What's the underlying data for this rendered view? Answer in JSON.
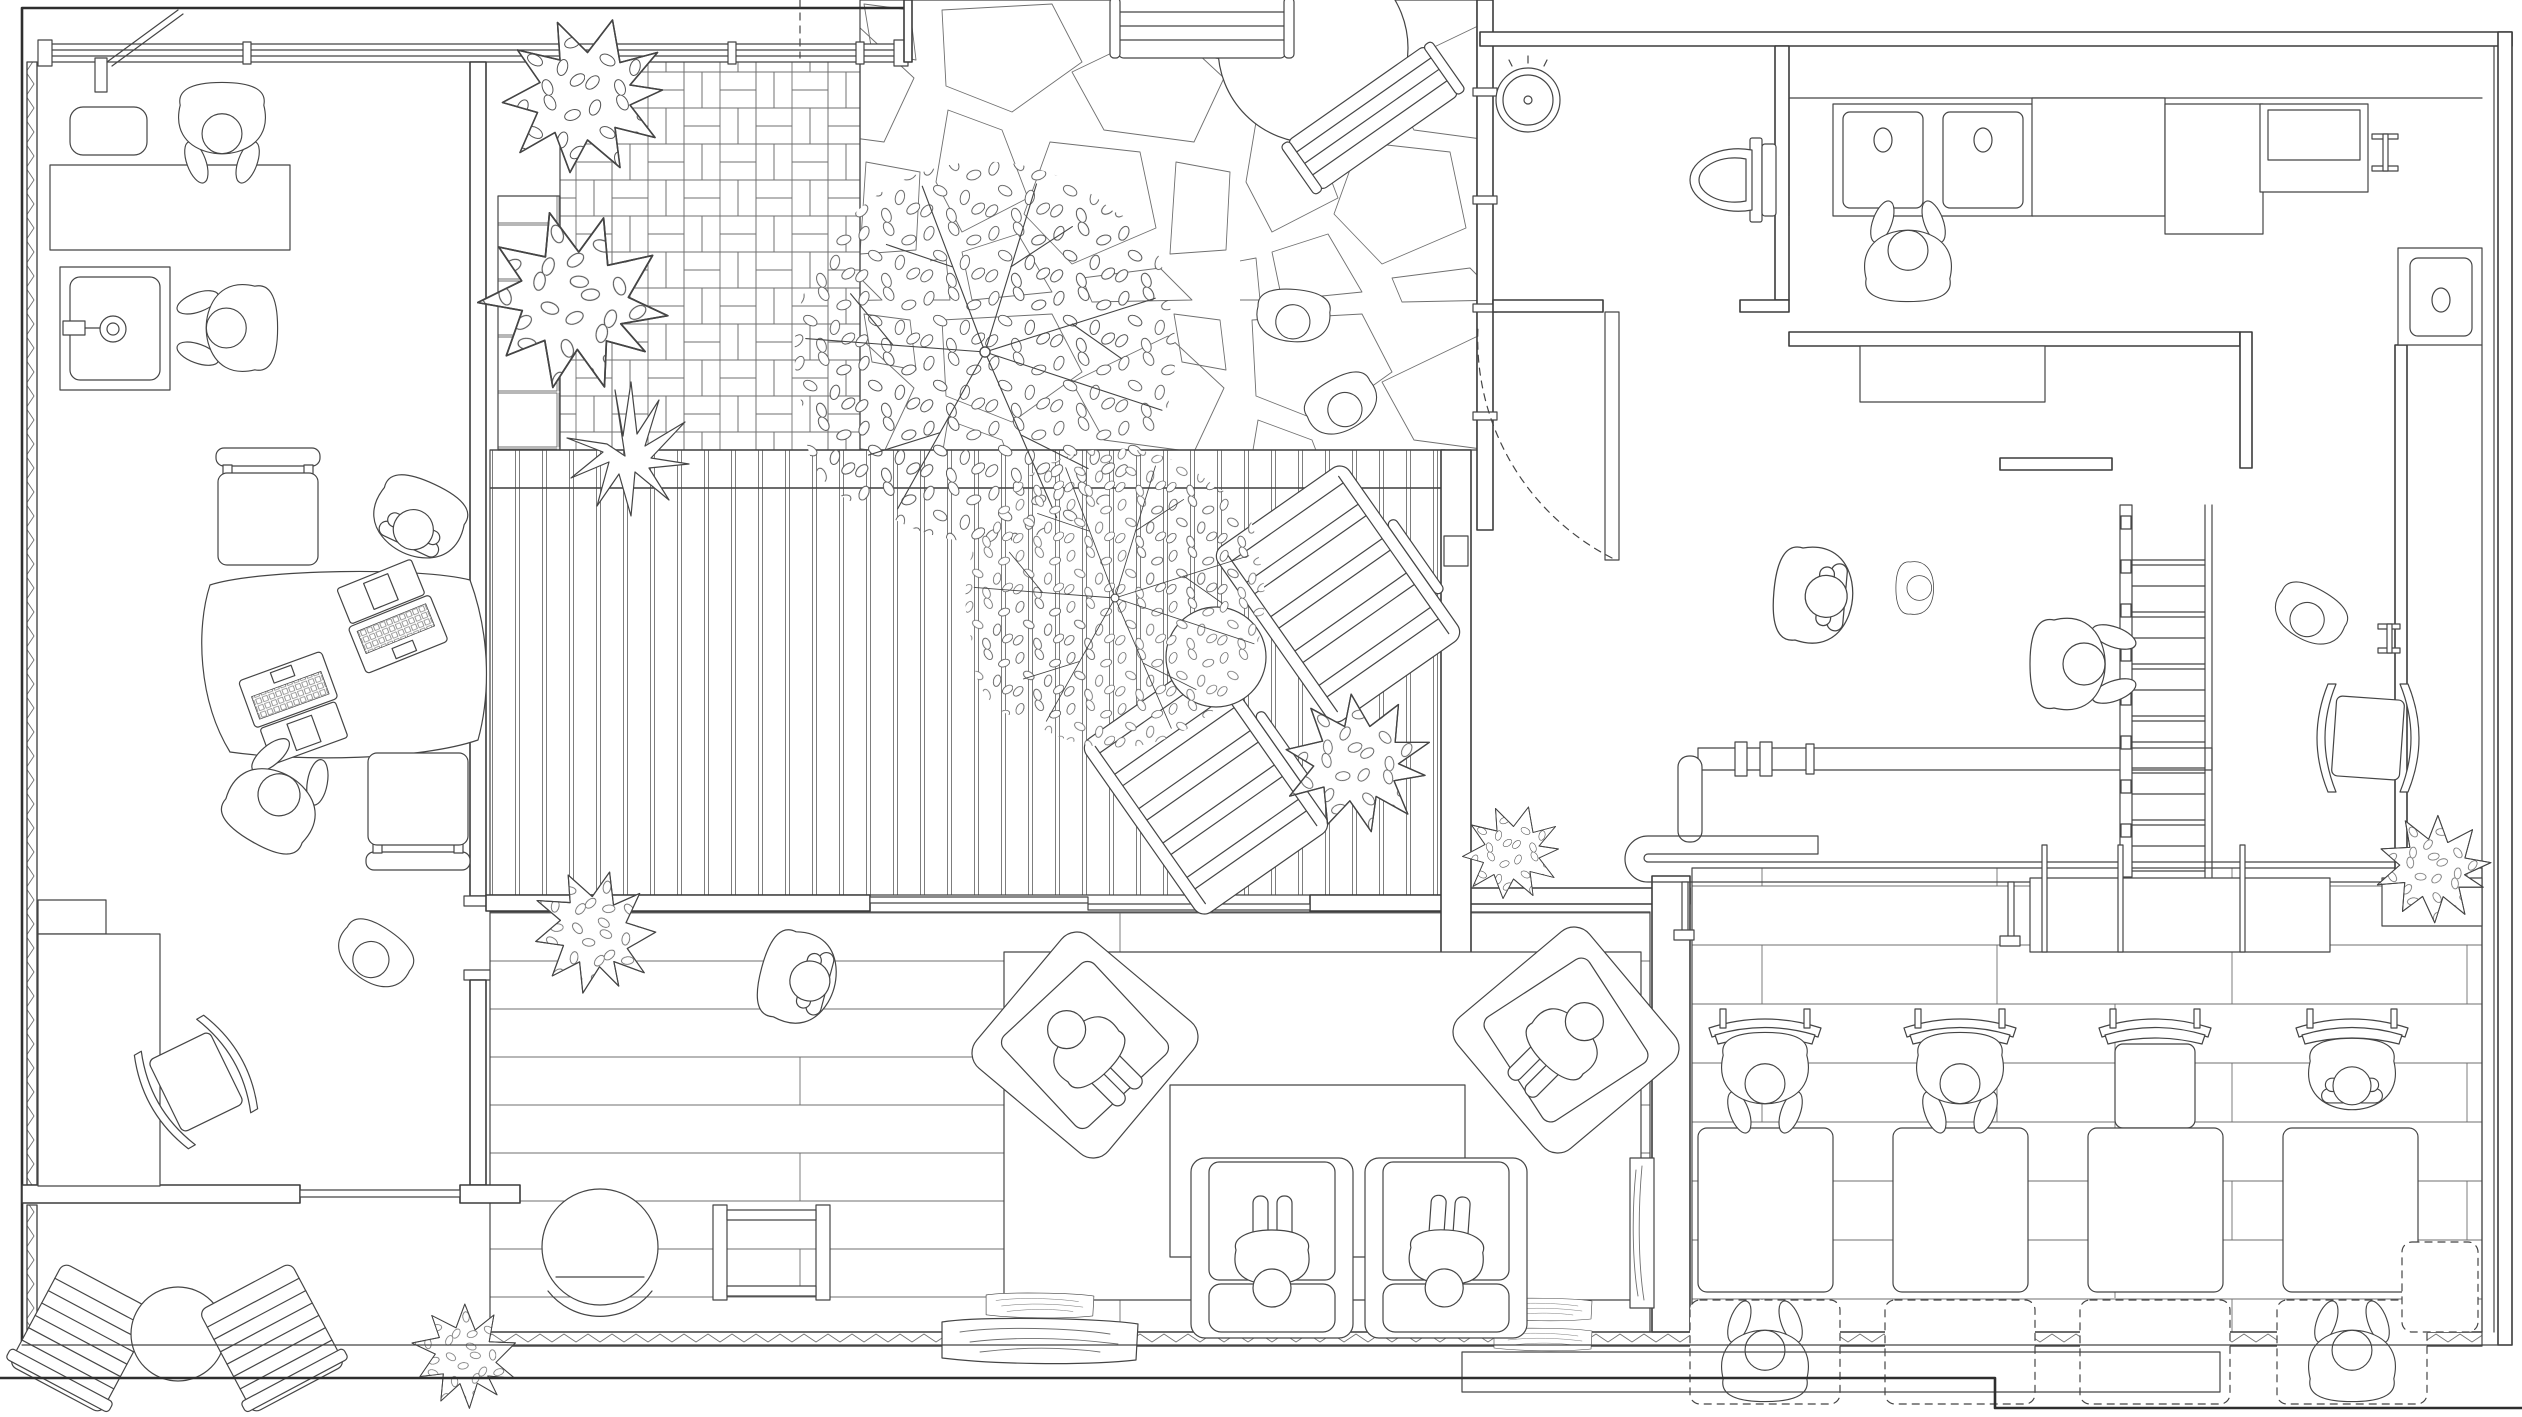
{
  "document": {
    "title": "Architectural floor plan (top view, black-and-white line drawing) of a co-living house: office studio, courtyard garden, timber deck, WC, kitchen, stair hall, lounge and dining study hall",
    "type": "floor-plan",
    "drawing_style": "monochrome CAD linework, no text labels, no dimensions"
  },
  "palette": {
    "background": "#ffffff",
    "linework": "#454545",
    "walls": "#3c3c3c",
    "pattern_linework": "#6f6f6f"
  },
  "floor_finishes": [
    "basketweave brick paving (courtyard)",
    "large stacked pavers (courtyard edge strip)",
    "crazy paving stone (courtyard path)",
    "vertical timber decking (terrace)",
    "wide timber planks (lounge)",
    "running-bond brick paviors (dining hall)"
  ],
  "rooms": [
    {
      "id": "office",
      "name": "office studio",
      "people": 5,
      "items": [
        "worktop appliance",
        "service counter",
        "inset sink with mixer tap",
        "organic work table",
        "laptop x2",
        "task chair x2",
        "storage cabinet",
        "rocking chair",
        "sliding door"
      ]
    },
    {
      "id": "courtyard",
      "name": "courtyard garden",
      "people": 2,
      "items": [
        "round table",
        "slatted bench x2",
        "large leafy tree",
        "shrub bed",
        "agave plant",
        "glazed screen wall"
      ]
    },
    {
      "id": "deck",
      "name": "deck terrace",
      "people": 0,
      "items": [
        "sun lounger x2",
        "ball side table",
        "small leafy tree",
        "shrub"
      ]
    },
    {
      "id": "wc",
      "name": "wc / powder room",
      "people": 0,
      "items": [
        "toilet",
        "round basin",
        "pivot door with swing arc"
      ]
    },
    {
      "id": "kitchen",
      "name": "kitchen",
      "people": 1,
      "items": [
        "double sink",
        "base unit run",
        "tall unit",
        "wall cabinet",
        "tap rail",
        "corner sink",
        "island bench"
      ]
    },
    {
      "id": "hall",
      "name": "stair hall / services",
      "people": 4,
      "items": [
        "open stair",
        "exposed service pipe with flanges",
        "foot-rail pipe with u-bend",
        "support post x3",
        "potted shrub",
        "rocking chair",
        "door pull"
      ]
    },
    {
      "id": "living",
      "name": "sunken lounge",
      "people": 5,
      "items": [
        "area rug",
        "coffee table",
        "lounge armchair x2",
        "sofa seat x2",
        "egg chair",
        "side stool frame",
        "live-edge wood slab x2",
        "media panel",
        "indoor shrub"
      ]
    },
    {
      "id": "dining",
      "name": "dining / study hall",
      "people": 5,
      "items": [
        "service counter with posts",
        "planter box with shrub",
        "table x4",
        "curved-back chair x4",
        "bench seat (dashed) x5"
      ]
    },
    {
      "id": "patio",
      "name": "garden patio",
      "people": 0,
      "items": [
        "slatted lounger x2",
        "round table",
        "shrub",
        "terrace step"
      ]
    }
  ],
  "people_total": 22,
  "people": [
    {
      "room": "office",
      "pose": "standing at worktop"
    },
    {
      "room": "office",
      "pose": "washing hands at sink"
    },
    {
      "room": "office",
      "pose": "seated at desk, arms crossed"
    },
    {
      "room": "office",
      "pose": "seated at desk, typing"
    },
    {
      "room": "office",
      "pose": "walking"
    },
    {
      "room": "courtyard",
      "pose": "standing"
    },
    {
      "room": "courtyard",
      "pose": "standing"
    },
    {
      "room": "kitchen",
      "pose": "standing at double sink"
    },
    {
      "room": "hall",
      "pose": "standing, arms crossed"
    },
    {
      "room": "hall",
      "pose": "child standing"
    },
    {
      "room": "hall",
      "pose": "climbing stair"
    },
    {
      "room": "hall",
      "pose": "walking in corridor"
    },
    {
      "room": "living",
      "pose": "lying on floor"
    },
    {
      "room": "living",
      "pose": "lounging in armchair"
    },
    {
      "room": "living",
      "pose": "lounging in armchair"
    },
    {
      "room": "living",
      "pose": "seated on sofa"
    },
    {
      "room": "living",
      "pose": "seated on sofa"
    },
    {
      "room": "dining",
      "pose": "seated at table, leaning over"
    },
    {
      "room": "dining",
      "pose": "seated at table, leaning over"
    },
    {
      "room": "dining",
      "pose": "seated at table, arms crossed"
    },
    {
      "room": "dining",
      "pose": "seated on bench"
    },
    {
      "room": "dining",
      "pose": "seated on bench"
    }
  ]
}
